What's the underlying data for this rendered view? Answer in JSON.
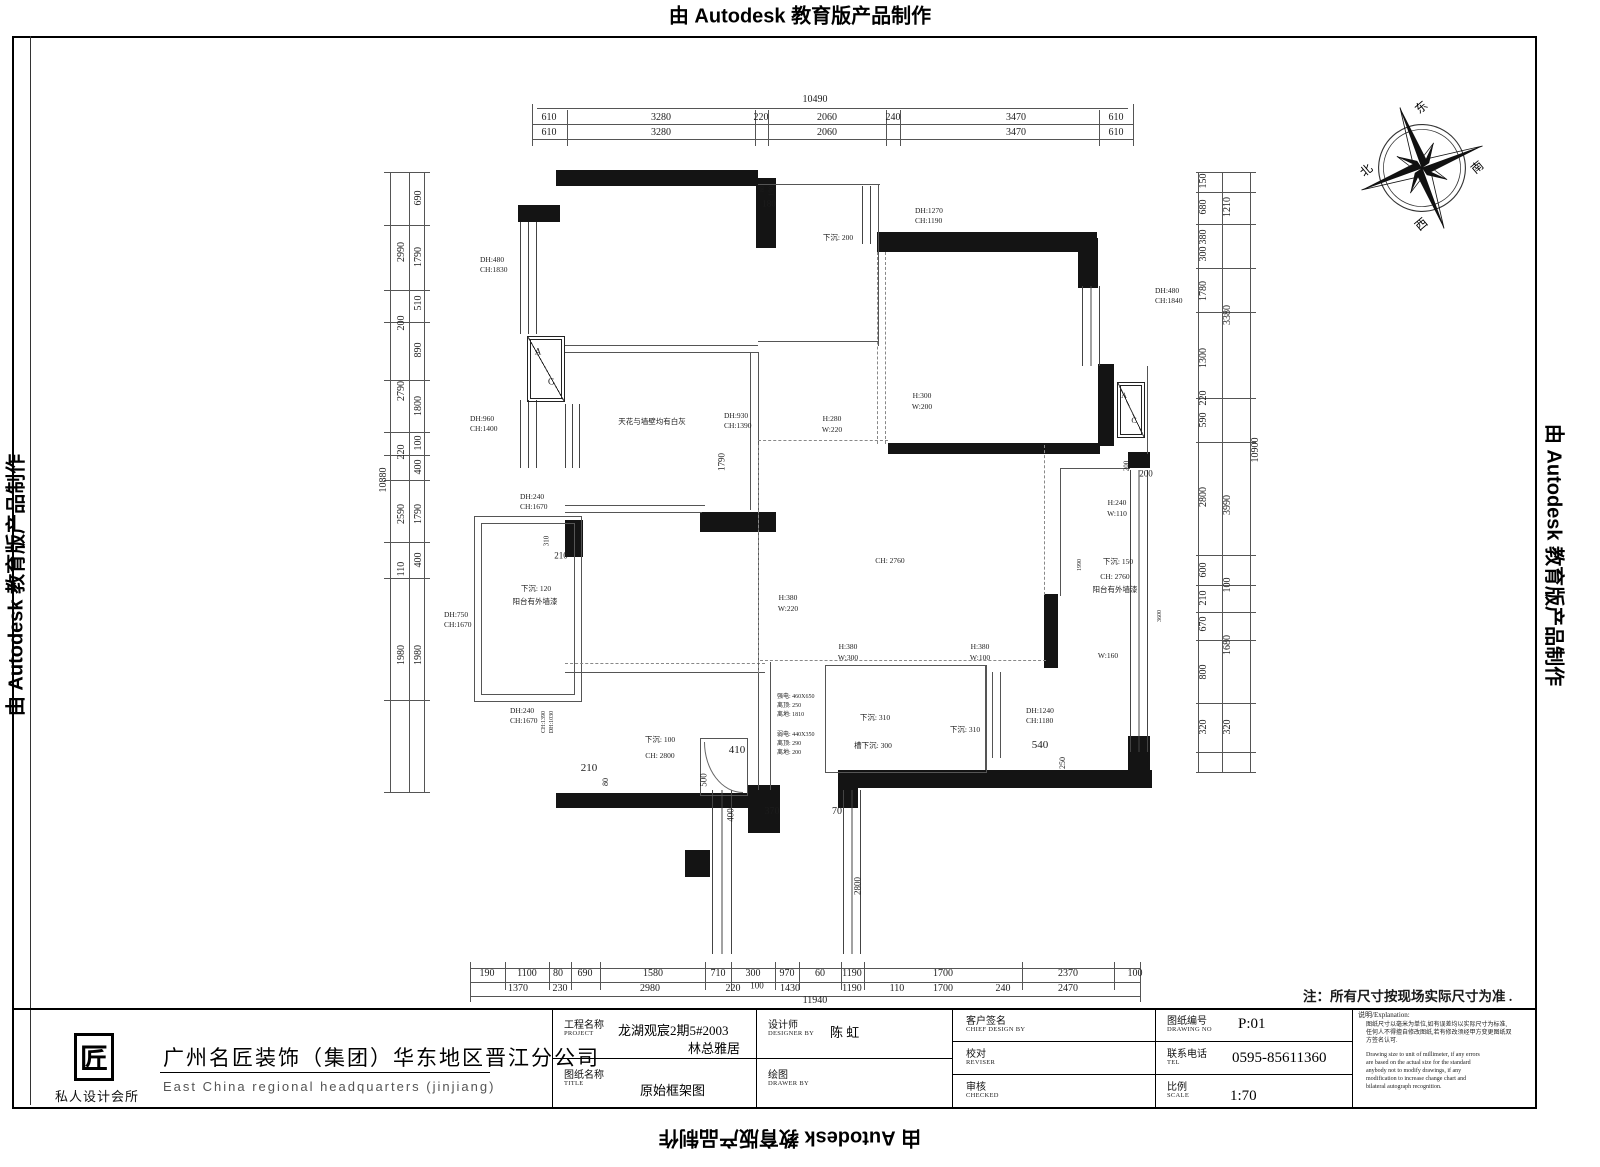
{
  "banner": {
    "text": "由 Autodesk 教育版产品制作"
  },
  "note": "注：所有尺寸按现场实际尺寸为准 .",
  "compass": {
    "east": "东",
    "south": "南",
    "west": "西",
    "north": "北"
  },
  "company": {
    "logo_glyph": "匠",
    "tagline": "私人设计会所",
    "name_cn": "广州名匠装饰（集团）华东地区晋江分公司",
    "name_en": "East China regional headquarters (jinjiang)"
  },
  "title_block": {
    "project_label": "工程名称",
    "project_label_en": "PROJECT",
    "project_value_1": "龙湖观宸2期5#2003",
    "project_value_2": "林总雅居",
    "designer_label": "设计师",
    "designer_label_en": "DESIGNER BY",
    "designer_value": "陈 虹",
    "sheet_label": "图纸名称",
    "sheet_label_en": "TITLE",
    "sheet_value": "原始框架图",
    "drawer_label": "绘图",
    "drawer_label_en": "DRAWER BY",
    "drawer_value": "",
    "client_label": "客户签名",
    "client_label_en": "CHIEF DESIGN BY",
    "reviser_label": "校对",
    "reviser_label_en": "REVISER",
    "checked_label": "审核",
    "checked_label_en": "CHECKED",
    "no_label": "图纸编号",
    "no_label_en": "DRAWING NO",
    "no_value": "P:01",
    "tel_label": "联系电话",
    "tel_label_en": "TEL",
    "tel_value": "0595-85611360",
    "scale_label": "比例",
    "scale_label_en": "SCALE",
    "scale_value": "1:70"
  },
  "explanation": {
    "title": "说明/Explanation:",
    "lines_cn": [
      "图纸尺寸以毫米为单位,如有误差均以实际尺寸为标准,",
      "任何人不得擅自修改图纸,若有修改须经甲方变更图纸双",
      "方签名认可."
    ],
    "lines_en": [
      "Drawing size to unit of millimeter, if any errors",
      "are based on the actual size for the standard",
      "anybody not to modify drawings, if any",
      "modification to increase change chart and",
      "bilateral autograph recognition."
    ]
  },
  "labels": [
    {
      "t": "10490",
      "x": 815,
      "y": 100,
      "s": 10
    },
    {
      "t": "610",
      "x": 549,
      "y": 118,
      "s": 10
    },
    {
      "t": "3280",
      "x": 661,
      "y": 118,
      "s": 10
    },
    {
      "t": "220",
      "x": 761,
      "y": 118,
      "s": 10
    },
    {
      "t": "2060",
      "x": 827,
      "y": 118,
      "s": 10
    },
    {
      "t": "240",
      "x": 893,
      "y": 118,
      "s": 10
    },
    {
      "t": "3470",
      "x": 1016,
      "y": 118,
      "s": 10
    },
    {
      "t": "610",
      "x": 1116,
      "y": 118,
      "s": 10
    },
    {
      "t": "610",
      "x": 549,
      "y": 133,
      "s": 10
    },
    {
      "t": "3280",
      "x": 661,
      "y": 133,
      "s": 10
    },
    {
      "t": "2060",
      "x": 827,
      "y": 133,
      "s": 10
    },
    {
      "t": "3470",
      "x": 1016,
      "y": 133,
      "s": 10
    },
    {
      "t": "610",
      "x": 1116,
      "y": 133,
      "s": 10
    },
    {
      "t": "10880",
      "x": 384,
      "y": 480,
      "r": 1,
      "s": 10
    },
    {
      "t": "2990",
      "x": 402,
      "y": 252,
      "r": 1,
      "s": 10
    },
    {
      "t": "200",
      "x": 402,
      "y": 323,
      "r": 1,
      "s": 10
    },
    {
      "t": "2790",
      "x": 402,
      "y": 391,
      "r": 1,
      "s": 10
    },
    {
      "t": "220",
      "x": 402,
      "y": 452,
      "r": 1,
      "s": 10
    },
    {
      "t": "2590",
      "x": 402,
      "y": 514,
      "r": 1,
      "s": 10
    },
    {
      "t": "110",
      "x": 402,
      "y": 569,
      "r": 1,
      "s": 10
    },
    {
      "t": "1980",
      "x": 402,
      "y": 655,
      "r": 1,
      "s": 10
    },
    {
      "t": "690",
      "x": 419,
      "y": 198,
      "r": 1,
      "s": 10
    },
    {
      "t": "1790",
      "x": 419,
      "y": 257,
      "r": 1,
      "s": 10
    },
    {
      "t": "510",
      "x": 419,
      "y": 303,
      "r": 1,
      "s": 10
    },
    {
      "t": "890",
      "x": 419,
      "y": 350,
      "r": 1,
      "s": 10
    },
    {
      "t": "1800",
      "x": 419,
      "y": 406,
      "r": 1,
      "s": 10
    },
    {
      "t": "100",
      "x": 419,
      "y": 443,
      "r": 1,
      "s": 10
    },
    {
      "t": "400",
      "x": 419,
      "y": 467,
      "r": 1,
      "s": 10
    },
    {
      "t": "1790",
      "x": 419,
      "y": 514,
      "r": 1,
      "s": 10
    },
    {
      "t": "400",
      "x": 419,
      "y": 560,
      "r": 1,
      "s": 10
    },
    {
      "t": "1980",
      "x": 419,
      "y": 655,
      "r": 1,
      "s": 10
    },
    {
      "t": "150",
      "x": 1204,
      "y": 181,
      "r": 1,
      "s": 10
    },
    {
      "t": "680",
      "x": 1204,
      "y": 207,
      "r": 1,
      "s": 10
    },
    {
      "t": "380",
      "x": 1204,
      "y": 237,
      "r": 1,
      "s": 10
    },
    {
      "t": "300",
      "x": 1204,
      "y": 254,
      "r": 1,
      "s": 10
    },
    {
      "t": "1780",
      "x": 1204,
      "y": 291,
      "r": 1,
      "s": 10
    },
    {
      "t": "1300",
      "x": 1204,
      "y": 358,
      "r": 1,
      "s": 10
    },
    {
      "t": "220",
      "x": 1204,
      "y": 398,
      "r": 1,
      "s": 10
    },
    {
      "t": "590",
      "x": 1204,
      "y": 420,
      "r": 1,
      "s": 10
    },
    {
      "t": "2800",
      "x": 1204,
      "y": 497,
      "r": 1,
      "s": 10
    },
    {
      "t": "600",
      "x": 1204,
      "y": 570,
      "r": 1,
      "s": 10
    },
    {
      "t": "210",
      "x": 1204,
      "y": 598,
      "r": 1,
      "s": 10
    },
    {
      "t": "670",
      "x": 1204,
      "y": 624,
      "r": 1,
      "s": 10
    },
    {
      "t": "800",
      "x": 1204,
      "y": 672,
      "r": 1,
      "s": 10
    },
    {
      "t": "320",
      "x": 1204,
      "y": 727,
      "r": 1,
      "s": 10
    },
    {
      "t": "1210",
      "x": 1228,
      "y": 207,
      "r": 1,
      "s": 10
    },
    {
      "t": "3380",
      "x": 1228,
      "y": 315,
      "r": 1,
      "s": 10
    },
    {
      "t": "3990",
      "x": 1228,
      "y": 505,
      "r": 1,
      "s": 10
    },
    {
      "t": "100",
      "x": 1228,
      "y": 585,
      "r": 1,
      "s": 10
    },
    {
      "t": "1680",
      "x": 1228,
      "y": 645,
      "r": 1,
      "s": 10
    },
    {
      "t": "320",
      "x": 1228,
      "y": 727,
      "r": 1,
      "s": 10
    },
    {
      "t": "10900",
      "x": 1256,
      "y": 450,
      "r": 1,
      "s": 10
    },
    {
      "t": "190",
      "x": 487,
      "y": 974,
      "s": 10
    },
    {
      "t": "1100",
      "x": 527,
      "y": 974,
      "s": 10
    },
    {
      "t": "80",
      "x": 558,
      "y": 974,
      "s": 10
    },
    {
      "t": "690",
      "x": 585,
      "y": 974,
      "s": 10
    },
    {
      "t": "1580",
      "x": 653,
      "y": 974,
      "s": 10
    },
    {
      "t": "710",
      "x": 718,
      "y": 974,
      "s": 10
    },
    {
      "t": "300",
      "x": 753,
      "y": 974,
      "s": 10
    },
    {
      "t": "970",
      "x": 787,
      "y": 974,
      "s": 10
    },
    {
      "t": "60",
      "x": 820,
      "y": 974,
      "s": 10
    },
    {
      "t": "1190",
      "x": 852,
      "y": 974,
      "s": 10
    },
    {
      "t": "1700",
      "x": 943,
      "y": 974,
      "s": 10
    },
    {
      "t": "2370",
      "x": 1068,
      "y": 974,
      "s": 10
    },
    {
      "t": "100",
      "x": 1135,
      "y": 974,
      "s": 10
    },
    {
      "t": "1370",
      "x": 518,
      "y": 989,
      "s": 10
    },
    {
      "t": "230",
      "x": 560,
      "y": 989,
      "s": 10
    },
    {
      "t": "2980",
      "x": 650,
      "y": 989,
      "s": 10
    },
    {
      "t": "220",
      "x": 733,
      "y": 989,
      "s": 10
    },
    {
      "t": "100",
      "x": 757,
      "y": 986,
      "s": 9
    },
    {
      "t": "1430",
      "x": 790,
      "y": 989,
      "s": 10
    },
    {
      "t": "1190",
      "x": 852,
      "y": 989,
      "s": 10
    },
    {
      "t": "110",
      "x": 897,
      "y": 989,
      "s": 10
    },
    {
      "t": "1700",
      "x": 943,
      "y": 989,
      "s": 10
    },
    {
      "t": "240",
      "x": 1003,
      "y": 989,
      "s": 10
    },
    {
      "t": "2470",
      "x": 1068,
      "y": 989,
      "s": 10
    },
    {
      "t": "11940",
      "x": 815,
      "y": 1001,
      "s": 10
    },
    {
      "t": "DH:480",
      "x": 480,
      "y": 260,
      "a": 1
    },
    {
      "t": "CH:1830",
      "x": 480,
      "y": 270,
      "a": 1
    },
    {
      "t": "80",
      "x": 763,
      "y": 189,
      "r": 1,
      "s": 6
    },
    {
      "t": "190",
      "x": 772,
      "y": 191,
      "r": 1,
      "s": 7
    },
    {
      "t": "180",
      "x": 769,
      "y": 204,
      "s": 9
    },
    {
      "t": "下沉: 200",
      "x": 838,
      "y": 238
    },
    {
      "t": "DH:1270",
      "x": 915,
      "y": 211,
      "a": 1
    },
    {
      "t": "CH:1190",
      "x": 915,
      "y": 221,
      "a": 1
    },
    {
      "t": "DH:480",
      "x": 1155,
      "y": 291,
      "a": 1
    },
    {
      "t": "CH:1840",
      "x": 1155,
      "y": 301,
      "a": 1
    },
    {
      "t": "A",
      "x": 538,
      "y": 352,
      "s": 9
    },
    {
      "t": "C",
      "x": 551,
      "y": 382,
      "s": 9
    },
    {
      "t": "A",
      "x": 1124,
      "y": 396,
      "s": 8
    },
    {
      "t": "C",
      "x": 1134,
      "y": 421,
      "s": 8
    },
    {
      "t": "H:300",
      "x": 922,
      "y": 396
    },
    {
      "t": "W:200",
      "x": 922,
      "y": 407
    },
    {
      "t": "DH:960",
      "x": 470,
      "y": 419,
      "a": 1
    },
    {
      "t": "CH:1400",
      "x": 470,
      "y": 429,
      "a": 1
    },
    {
      "t": "天花与墙壁均有白灰",
      "x": 652,
      "y": 422
    },
    {
      "t": "DH:930",
      "x": 724,
      "y": 416,
      "a": 1
    },
    {
      "t": "CH:1390",
      "x": 724,
      "y": 426,
      "a": 1
    },
    {
      "t": "1790",
      "x": 722,
      "y": 462,
      "r": 1,
      "s": 9
    },
    {
      "t": "H:280",
      "x": 832,
      "y": 419
    },
    {
      "t": "W:220",
      "x": 832,
      "y": 430
    },
    {
      "t": "200",
      "x": 1127,
      "y": 466,
      "r": 1,
      "s": 7
    },
    {
      "t": "200",
      "x": 1146,
      "y": 474,
      "s": 9
    },
    {
      "t": "H:240",
      "x": 1117,
      "y": 503
    },
    {
      "t": "W:110",
      "x": 1117,
      "y": 514
    },
    {
      "t": "310",
      "x": 547,
      "y": 541,
      "r": 1,
      "s": 7
    },
    {
      "t": "210",
      "x": 561,
      "y": 556,
      "s": 9
    },
    {
      "t": "DH:240",
      "x": 520,
      "y": 497,
      "a": 1
    },
    {
      "t": "CH:1670",
      "x": 520,
      "y": 507,
      "a": 1
    },
    {
      "t": "下沉: 120",
      "x": 536,
      "y": 589
    },
    {
      "t": "阳台有外墙漆",
      "x": 535,
      "y": 602
    },
    {
      "t": "DH:750",
      "x": 444,
      "y": 615,
      "a": 1
    },
    {
      "t": "CH:1670",
      "x": 444,
      "y": 625,
      "a": 1
    },
    {
      "t": "DH:240",
      "x": 510,
      "y": 711,
      "a": 1
    },
    {
      "t": "CH:1670",
      "x": 510,
      "y": 721,
      "a": 1
    },
    {
      "t": "DH:1030",
      "x": 552,
      "y": 722,
      "r": 1,
      "s": 6
    },
    {
      "t": "CH:1390",
      "x": 544,
      "y": 722,
      "r": 1,
      "s": 6
    },
    {
      "t": "CH: 2760",
      "x": 890,
      "y": 561
    },
    {
      "t": "H:380",
      "x": 788,
      "y": 598
    },
    {
      "t": "W:220",
      "x": 788,
      "y": 609
    },
    {
      "t": "1990",
      "x": 1080,
      "y": 565,
      "r": 1,
      "s": 6
    },
    {
      "t": "下沉: 150",
      "x": 1118,
      "y": 562
    },
    {
      "t": "CH: 2760",
      "x": 1115,
      "y": 577
    },
    {
      "t": "阳台有外墙漆",
      "x": 1115,
      "y": 590
    },
    {
      "t": "3600",
      "x": 1160,
      "y": 616,
      "r": 1,
      "s": 6
    },
    {
      "t": "H:380",
      "x": 848,
      "y": 647
    },
    {
      "t": "W:300",
      "x": 848,
      "y": 658
    },
    {
      "t": "H:380",
      "x": 980,
      "y": 647
    },
    {
      "t": "W:100",
      "x": 980,
      "y": 658
    },
    {
      "t": "W:160",
      "x": 1108,
      "y": 656
    },
    {
      "t": "强电: 460X650",
      "x": 777,
      "y": 697,
      "a": 1,
      "s": 6
    },
    {
      "t": "离顶: 250",
      "x": 777,
      "y": 706,
      "a": 1,
      "s": 6
    },
    {
      "t": "离地: 1810",
      "x": 777,
      "y": 715,
      "a": 1,
      "s": 6
    },
    {
      "t": "弱电: 440X350",
      "x": 777,
      "y": 735,
      "a": 1,
      "s": 6
    },
    {
      "t": "离顶: 290",
      "x": 777,
      "y": 744,
      "a": 1,
      "s": 6
    },
    {
      "t": "离地: 200",
      "x": 777,
      "y": 753,
      "a": 1,
      "s": 6
    },
    {
      "t": "下沉: 310",
      "x": 875,
      "y": 718
    },
    {
      "t": "槽下沉: 300",
      "x": 873,
      "y": 746
    },
    {
      "t": "下沉: 310",
      "x": 965,
      "y": 730
    },
    {
      "t": "DH:1240",
      "x": 1026,
      "y": 711,
      "a": 1
    },
    {
      "t": "CH:1180",
      "x": 1026,
      "y": 721,
      "a": 1
    },
    {
      "t": "540",
      "x": 1040,
      "y": 746,
      "s": 11
    },
    {
      "t": "250",
      "x": 1063,
      "y": 763,
      "r": 1,
      "s": 8
    },
    {
      "t": "下沉: 100",
      "x": 660,
      "y": 740
    },
    {
      "t": "CH: 2800",
      "x": 660,
      "y": 756
    },
    {
      "t": "210",
      "x": 589,
      "y": 769,
      "s": 11
    },
    {
      "t": "80",
      "x": 606,
      "y": 782,
      "r": 1,
      "s": 8
    },
    {
      "t": "410",
      "x": 737,
      "y": 751,
      "s": 11
    },
    {
      "t": "500",
      "x": 704,
      "y": 780,
      "r": 1,
      "s": 9
    },
    {
      "t": "400",
      "x": 731,
      "y": 815,
      "r": 1,
      "s": 9
    },
    {
      "t": "370",
      "x": 772,
      "y": 812,
      "s": 10
    },
    {
      "t": "70",
      "x": 837,
      "y": 812,
      "s": 10
    },
    {
      "t": "2800",
      "x": 858,
      "y": 886,
      "r": 1,
      "s": 9
    }
  ]
}
